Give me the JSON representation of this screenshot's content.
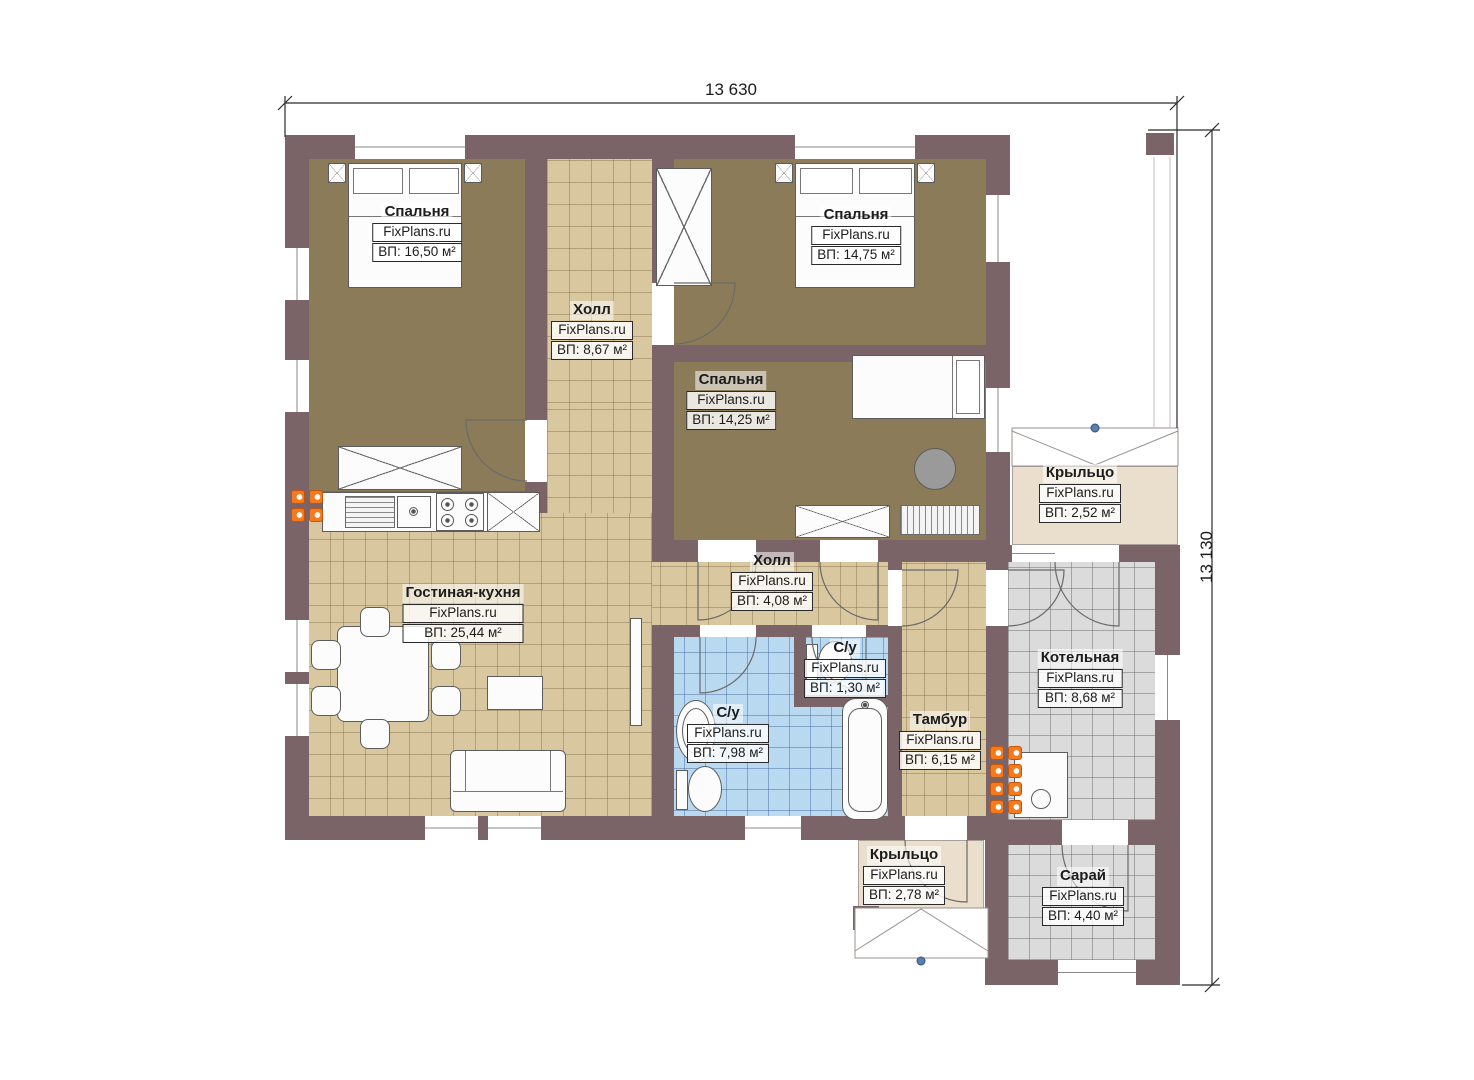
{
  "brand": "FixPlans.ru",
  "dimensions": {
    "top": "13 630",
    "right": "13 130"
  },
  "rooms": [
    {
      "key": "bedroom-1",
      "name": "Спальня",
      "brand": "FixPlans.ru",
      "area": "ВП: 16,50 м²"
    },
    {
      "key": "hall-1",
      "name": "Холл",
      "brand": "FixPlans.ru",
      "area": "ВП: 8,67 м²"
    },
    {
      "key": "bedroom-2",
      "name": "Спальня",
      "brand": "FixPlans.ru",
      "area": "ВП: 14,75 м²"
    },
    {
      "key": "bedroom-3",
      "name": "Спальня",
      "brand": "FixPlans.ru",
      "area": "ВП: 14,25 м²"
    },
    {
      "key": "porch-top",
      "name": "Крыльцо",
      "brand": "FixPlans.ru",
      "area": "ВП: 2,52 м²"
    },
    {
      "key": "living-kitchen",
      "name": "Гостиная-кухня",
      "brand": "FixPlans.ru",
      "area": "ВП: 25,44 м²"
    },
    {
      "key": "hall-2",
      "name": "Холл",
      "brand": "FixPlans.ru",
      "area": "ВП: 4,08 м²"
    },
    {
      "key": "wc-small",
      "name": "С/у",
      "brand": "FixPlans.ru",
      "area": "ВП: 1,30 м²"
    },
    {
      "key": "wc-big",
      "name": "С/у",
      "brand": "FixPlans.ru",
      "area": "ВП: 7,98 м²"
    },
    {
      "key": "tambour",
      "name": "Тамбур",
      "brand": "FixPlans.ru",
      "area": "ВП: 6,15 м²"
    },
    {
      "key": "boiler-room",
      "name": "Котельная",
      "brand": "FixPlans.ru",
      "area": "ВП: 8,68 м²"
    },
    {
      "key": "porch-bottom",
      "name": "Крыльцо",
      "brand": "FixPlans.ru",
      "area": "ВП: 2,78 м²"
    },
    {
      "key": "shed",
      "name": "Сарай",
      "brand": "FixPlans.ru",
      "area": "ВП: 4,40 м²"
    }
  ],
  "colors": {
    "wall": "#7a6467",
    "bedroom_floor": "#8b7b58",
    "tile_tan": "#d9c89f",
    "tile_blue": "#b9d9f1",
    "tile_gray": "#dbdbdb",
    "porch": "#eadfcc",
    "radiator": "#f57a1e",
    "marker_dot": "#5b7fae"
  }
}
